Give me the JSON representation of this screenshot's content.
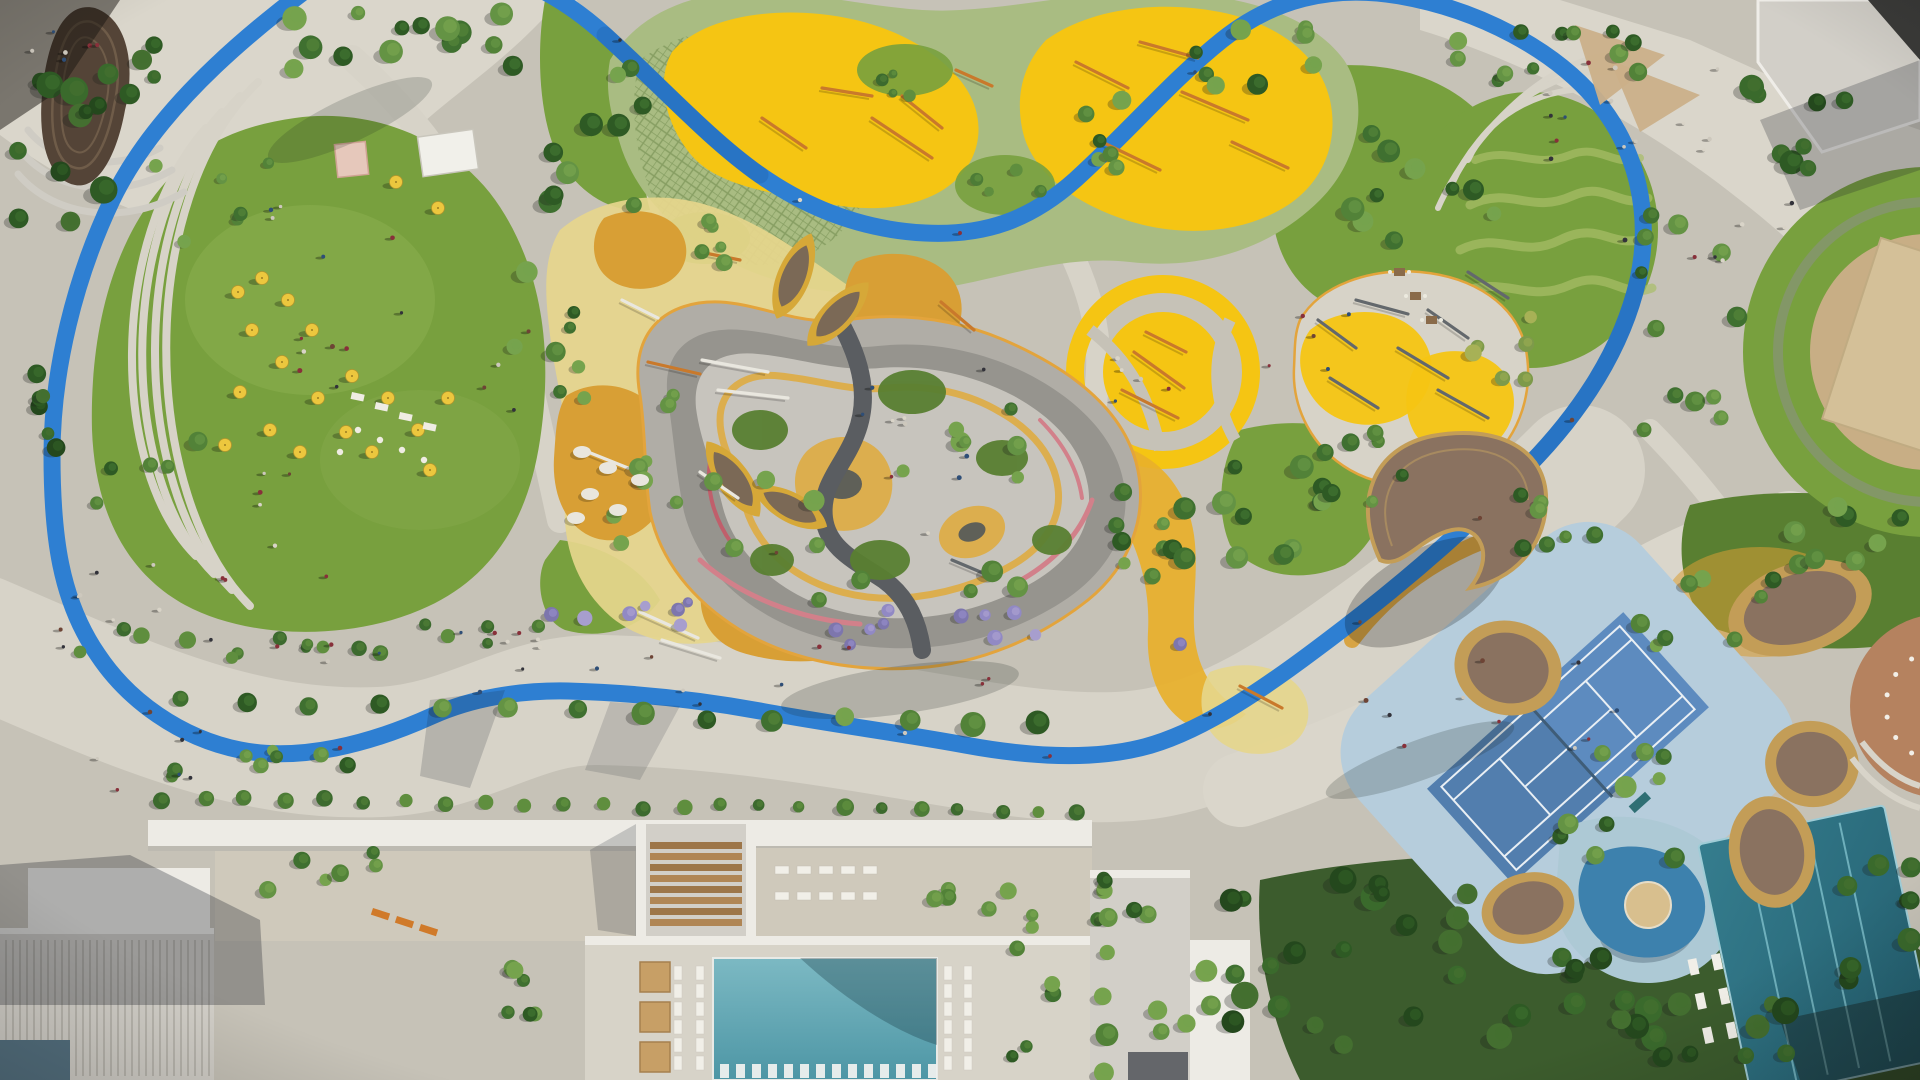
{
  "meta": {
    "title": "Aerial masterplan rendering of a landscaped residential park",
    "view": "top-down bird's-eye photorealistic render, daylight with long shadows",
    "notable_features": [
      "blue-running-track-loop",
      "great-lawn",
      "adventure-playground-yellow",
      "toddler-play-zone",
      "maze-garden-paths",
      "round-playground",
      "fitness-zone",
      "tennis-court",
      "kids-splash-pool",
      "lap-pool",
      "main-pool",
      "leaf-pavilions",
      "crescent-canopy",
      "pod-canopies",
      "spiral-pavilion",
      "amphitheater-steps",
      "promenade",
      "residential-buildings",
      "event-lawn-umbrellas"
    ]
  },
  "palette": {
    "pavement": "#c6c2b7",
    "pavement_light": "#d7d3c8",
    "pavement_warm": "#cfc9bb",
    "plaza": "#dad6cb",
    "lawn": "#78a03e",
    "lawn_light": "#8db152",
    "lawn_dark": "#597f31",
    "lawn_pale": "#a9bf68",
    "hedge": "#3f6a2c",
    "grove_ground": "#3c5c2d",
    "track": "#2e7fd2",
    "track_dark": "#1c5ca6",
    "soft_green": "#a9bc82",
    "play_yellow": "#f5c513",
    "play_deep": "#e8b02a",
    "ochre": "#d89f35",
    "pale_yellow": "#e6d68c",
    "maze_base": "#b0ada6",
    "maze_grey": "#96948e",
    "maze_light": "#c7c4bd",
    "maze_dark": "#5a5d61",
    "maze_pink": "#d2808a",
    "maze_red": "#c05f6b",
    "maze_yellow": "#dcae4e",
    "maze_navy": "#49525b",
    "maze_edge": "#e3a43c",
    "wood": "#8a7260",
    "wood_dark": "#544437",
    "wood_rim": "#c39d57",
    "leaf_rim": "#d6a838",
    "leaf_top": "#7b6956",
    "pool_a": "#7cb9c3",
    "pool_b": "#4d96a5",
    "lap_a": "#357d8e",
    "lap_b": "#235e6e",
    "lap_lane": "#7fc0cb",
    "kids_pool": "#3d81ad",
    "kids_apron": "#adc9d5",
    "sand": "#d8bf8e",
    "tennis_apron": "#b6cddc",
    "tennis_court": "#5d8bbf",
    "tennis_dark": "#4b77a4",
    "tennis_line": "#e9eff4",
    "bld_white": "#edebe5",
    "bld_grey": "#d2cfc8",
    "bld_wall": "#b9b6ae",
    "fin": "#b3b0a8",
    "roof_dark": "#64666a",
    "roof_black": "#3b3b39",
    "mosaic": "#54707f",
    "terracotta": "#b5825f",
    "tan_circle": "#c8ae85",
    "tan_bld": "#d4c098",
    "tent": "#e6c8bb",
    "stage": "#f1f0ea",
    "cabana": "#c79f66",
    "lounger": "#f1efe8",
    "umbrella": "#ecc73e",
    "bench_orange": "#d07a2a",
    "orange_eq": "#c9792b",
    "white_eq": "#e9e7df",
    "grey_eq": "#63686c",
    "sail": "#cbb089",
    "people_colors": [
      "#32323a",
      "#6e4435",
      "#cdc8bd",
      "#88303a",
      "#2e4e77",
      "#d9d4c8"
    ],
    "tree": {
      "std": [
        "#2e5a24",
        "#3f7030",
        "#528238",
        "#649344",
        "#76a34d"
      ],
      "dark": [
        "#24481d",
        "#2e5a24",
        "#3a6a2c",
        "#446f30"
      ],
      "olive": [
        "#7d9a4a",
        "#93a850",
        "#a7b156"
      ],
      "lilac": [
        "#7d76ad",
        "#9189c4",
        "#a79ece"
      ],
      "shrub": [
        "#3c6a2e",
        "#4d7c36",
        "#5f8e3e"
      ]
    }
  },
  "trees": {
    "clusters": [
      [
        420,
        40,
        130,
        32,
        14,
        7,
        13,
        "std"
      ],
      [
        60,
        150,
        45,
        85,
        9,
        8,
        14,
        "dark"
      ],
      [
        40,
        390,
        22,
        60,
        6,
        6,
        10,
        "dark"
      ],
      [
        150,
        470,
        55,
        45,
        5,
        6,
        10,
        "std"
      ],
      [
        295,
        640,
        250,
        18,
        18,
        5,
        9,
        "shrub"
      ],
      [
        590,
        150,
        55,
        85,
        10,
        7,
        12,
        "std"
      ],
      [
        545,
        330,
        40,
        70,
        8,
        6,
        11,
        "std"
      ],
      [
        645,
        475,
        35,
        85,
        8,
        6,
        10,
        "std"
      ],
      [
        880,
        495,
        175,
        120,
        17,
        6,
        11,
        "std"
      ],
      [
        1010,
        630,
        185,
        20,
        12,
        5,
        8,
        "lilac"
      ],
      [
        620,
        612,
        70,
        16,
        7,
        5,
        8,
        "lilac"
      ],
      [
        1148,
        520,
        42,
        80,
        8,
        6,
        10,
        "std"
      ],
      [
        1258,
        518,
        75,
        55,
        12,
        7,
        12,
        "std"
      ],
      [
        1350,
        468,
        60,
        40,
        7,
        6,
        10,
        "std"
      ],
      [
        1420,
        200,
        90,
        70,
        10,
        7,
        12,
        "std"
      ],
      [
        1690,
        320,
        55,
        110,
        12,
        6,
        11,
        "std"
      ],
      [
        1800,
        120,
        70,
        50,
        8,
        8,
        13,
        "dark"
      ],
      [
        1600,
        55,
        55,
        28,
        6,
        6,
        10,
        "std"
      ],
      [
        1400,
        955,
        175,
        90,
        24,
        8,
        14,
        "dark"
      ],
      [
        1700,
        1005,
        130,
        60,
        16,
        8,
        14,
        "dark"
      ],
      [
        1565,
        525,
        60,
        30,
        7,
        6,
        10,
        "std"
      ],
      [
        1700,
        610,
        80,
        38,
        8,
        6,
        10,
        "std"
      ],
      [
        1620,
        800,
        70,
        60,
        10,
        6,
        11,
        "std"
      ],
      [
        700,
        240,
        42,
        28,
        5,
        5,
        9,
        "std"
      ],
      [
        1085,
        140,
        50,
        40,
        6,
        6,
        10,
        "std"
      ],
      [
        240,
        765,
        110,
        25,
        8,
        5,
        9,
        "std"
      ],
      [
        525,
        995,
        22,
        70,
        6,
        6,
        9,
        "std"
      ],
      [
        1030,
        995,
        25,
        70,
        6,
        6,
        9,
        "std"
      ],
      [
        1255,
        65,
        70,
        40,
        8,
        6,
        11,
        "std"
      ],
      [
        210,
        205,
        70,
        55,
        6,
        5,
        8,
        "std"
      ],
      [
        105,
        80,
        50,
        40,
        7,
        6,
        11,
        "dark"
      ],
      [
        1508,
        345,
        40,
        35,
        6,
        6,
        10,
        "olive"
      ],
      [
        905,
        72,
        45,
        25,
        4,
        4,
        7,
        "shrub"
      ],
      [
        1005,
        185,
        45,
        28,
        4,
        4,
        7,
        "shrub"
      ],
      [
        1850,
        540,
        60,
        40,
        8,
        6,
        11,
        "std"
      ],
      [
        1880,
        920,
        40,
        60,
        8,
        7,
        12,
        "dark"
      ],
      [
        300,
        870,
        80,
        20,
        6,
        6,
        9,
        "std"
      ],
      [
        980,
        900,
        60,
        18,
        6,
        6,
        9,
        "std"
      ],
      [
        1120,
        900,
        50,
        25,
        6,
        6,
        9,
        "std"
      ],
      [
        1195,
        1000,
        40,
        40,
        6,
        7,
        11,
        "std"
      ],
      [
        1480,
        60,
        60,
        30,
        6,
        6,
        10,
        "std"
      ]
    ],
    "rows": [
      [
        180,
        700,
        1040,
        726,
        14,
        10,
        "std"
      ],
      [
        165,
        798,
        1080,
        812,
        24,
        7,
        "shrub"
      ],
      [
        1105,
        880,
        1105,
        1070,
        6,
        9,
        "std"
      ]
    ]
  },
  "scatter": {
    "people": [
      [
        400,
        300,
        130,
        110,
        16
      ],
      [
        300,
        520,
        110,
        60,
        8
      ],
      [
        760,
        665,
        280,
        26,
        12
      ],
      [
        340,
        645,
        180,
        18,
        8
      ],
      [
        1500,
        690,
        140,
        60,
        10
      ],
      [
        1640,
        120,
        110,
        60,
        14
      ],
      [
        120,
        610,
        70,
        50,
        8
      ],
      [
        150,
        760,
        60,
        30,
        6
      ],
      [
        980,
        450,
        130,
        90,
        6
      ],
      [
        1160,
        368,
        55,
        40,
        5
      ],
      [
        1740,
        240,
        60,
        40,
        6
      ],
      [
        60,
        40,
        40,
        25,
        6
      ],
      [
        880,
        490,
        120,
        80,
        5
      ],
      [
        1300,
        330,
        60,
        50,
        5
      ]
    ],
    "runners": [
      [
        150,
        712
      ],
      [
        340,
        748
      ],
      [
        480,
        692
      ],
      [
        700,
        704
      ],
      [
        905,
        733
      ],
      [
        1050,
        756
      ],
      [
        1210,
        714
      ],
      [
        1360,
        622
      ],
      [
        1480,
        518
      ],
      [
        1572,
        420
      ],
      [
        1625,
        240
      ],
      [
        1195,
        72
      ],
      [
        800,
        200
      ],
      [
        960,
        233
      ],
      [
        620,
        40
      ]
    ],
    "umbrellas": [
      [
        238,
        292
      ],
      [
        262,
        278
      ],
      [
        288,
        300
      ],
      [
        252,
        330
      ],
      [
        312,
        330
      ],
      [
        282,
        362
      ],
      [
        240,
        392
      ],
      [
        318,
        398
      ],
      [
        352,
        376
      ],
      [
        388,
        398
      ],
      [
        346,
        432
      ],
      [
        300,
        452
      ],
      [
        372,
        452
      ],
      [
        418,
        430
      ],
      [
        448,
        398
      ],
      [
        270,
        430
      ],
      [
        225,
        445
      ],
      [
        430,
        470
      ],
      [
        396,
        182
      ],
      [
        438,
        208
      ]
    ],
    "tables_round": [
      [
        358,
        430
      ],
      [
        380,
        440
      ],
      [
        402,
        450
      ],
      [
        424,
        460
      ],
      [
        340,
        452
      ]
    ],
    "buffet": [
      [
        352,
        392
      ],
      [
        376,
        402
      ],
      [
        400,
        412
      ],
      [
        424,
        422
      ]
    ],
    "pebbles": [
      [
        582,
        452
      ],
      [
        608,
        468
      ],
      [
        590,
        494
      ],
      [
        618,
        510
      ],
      [
        576,
        518
      ],
      [
        640,
        480
      ]
    ]
  },
  "furniture": {
    "pool_lounger_cols": {
      "xs": [
        674,
        696,
        944,
        964
      ],
      "y0": 966,
      "y1": 1072,
      "step": 18
    },
    "in_pool_row": {
      "y": 1064,
      "x0": 720,
      "x1": 928,
      "step": 16
    },
    "plaza_loungers": {
      "rows": [
        866,
        892
      ],
      "x0": 775,
      "x1": 863,
      "step": 22
    },
    "cabanas": {
      "x": 640,
      "y0": 962,
      "step": 40,
      "n": 3,
      "w": 30,
      "h": 30
    },
    "lap_loungers": {
      "cx": 1740,
      "cy": 1005,
      "xs": [
        1698,
        1722
      ],
      "ys": [
        950,
        985,
        1020
      ],
      "rot": -12
    },
    "benches_orange": [
      [
        373,
        908
      ],
      [
        397,
        916
      ],
      [
        421,
        924
      ]
    ],
    "nook_tables": [
      [
        1394,
        268
      ],
      [
        1410,
        292
      ],
      [
        1426,
        316
      ]
    ],
    "terracotta_chairs": {
      "cx": 1942,
      "cy": 706,
      "r": 56,
      "a0": 100,
      "a1": 260,
      "n": 8
    }
  },
  "equipment": {
    "orange": [
      [
        762,
        118,
        806,
        148
      ],
      [
        822,
        88,
        872,
        96
      ],
      [
        872,
        118,
        932,
        158
      ],
      [
        902,
        96,
        942,
        128
      ],
      [
        956,
        70,
        992,
        86
      ],
      [
        1076,
        62,
        1128,
        88
      ],
      [
        1140,
        42,
        1198,
        58
      ],
      [
        1182,
        92,
        1248,
        120
      ],
      [
        1232,
        142,
        1288,
        168
      ],
      [
        1102,
        142,
        1160,
        170
      ],
      [
        1134,
        352,
        1184,
        388
      ],
      [
        1122,
        390,
        1178,
        418
      ],
      [
        1146,
        332,
        1186,
        352
      ],
      [
        941,
        302,
        974,
        330
      ],
      [
        1240,
        686,
        1282,
        708
      ],
      [
        700,
        252,
        740,
        260
      ],
      [
        648,
        362,
        700,
        374
      ]
    ],
    "white": [
      [
        702,
        360,
        768,
        372
      ],
      [
        718,
        390,
        788,
        398
      ],
      [
        640,
        612,
        698,
        638
      ],
      [
        662,
        640,
        720,
        658
      ],
      [
        588,
        452,
        628,
        468
      ],
      [
        700,
        472,
        738,
        498
      ],
      [
        622,
        300,
        658,
        318
      ]
    ],
    "grey": [
      [
        1318,
        320,
        1356,
        348
      ],
      [
        1356,
        300,
        1408,
        314
      ],
      [
        1398,
        348,
        1448,
        378
      ],
      [
        1428,
        310,
        1468,
        338
      ],
      [
        1330,
        378,
        1378,
        408
      ],
      [
        1438,
        390,
        1488,
        418
      ],
      [
        1468,
        272,
        1508,
        298
      ],
      [
        952,
        560,
        990,
        576
      ]
    ]
  }
}
